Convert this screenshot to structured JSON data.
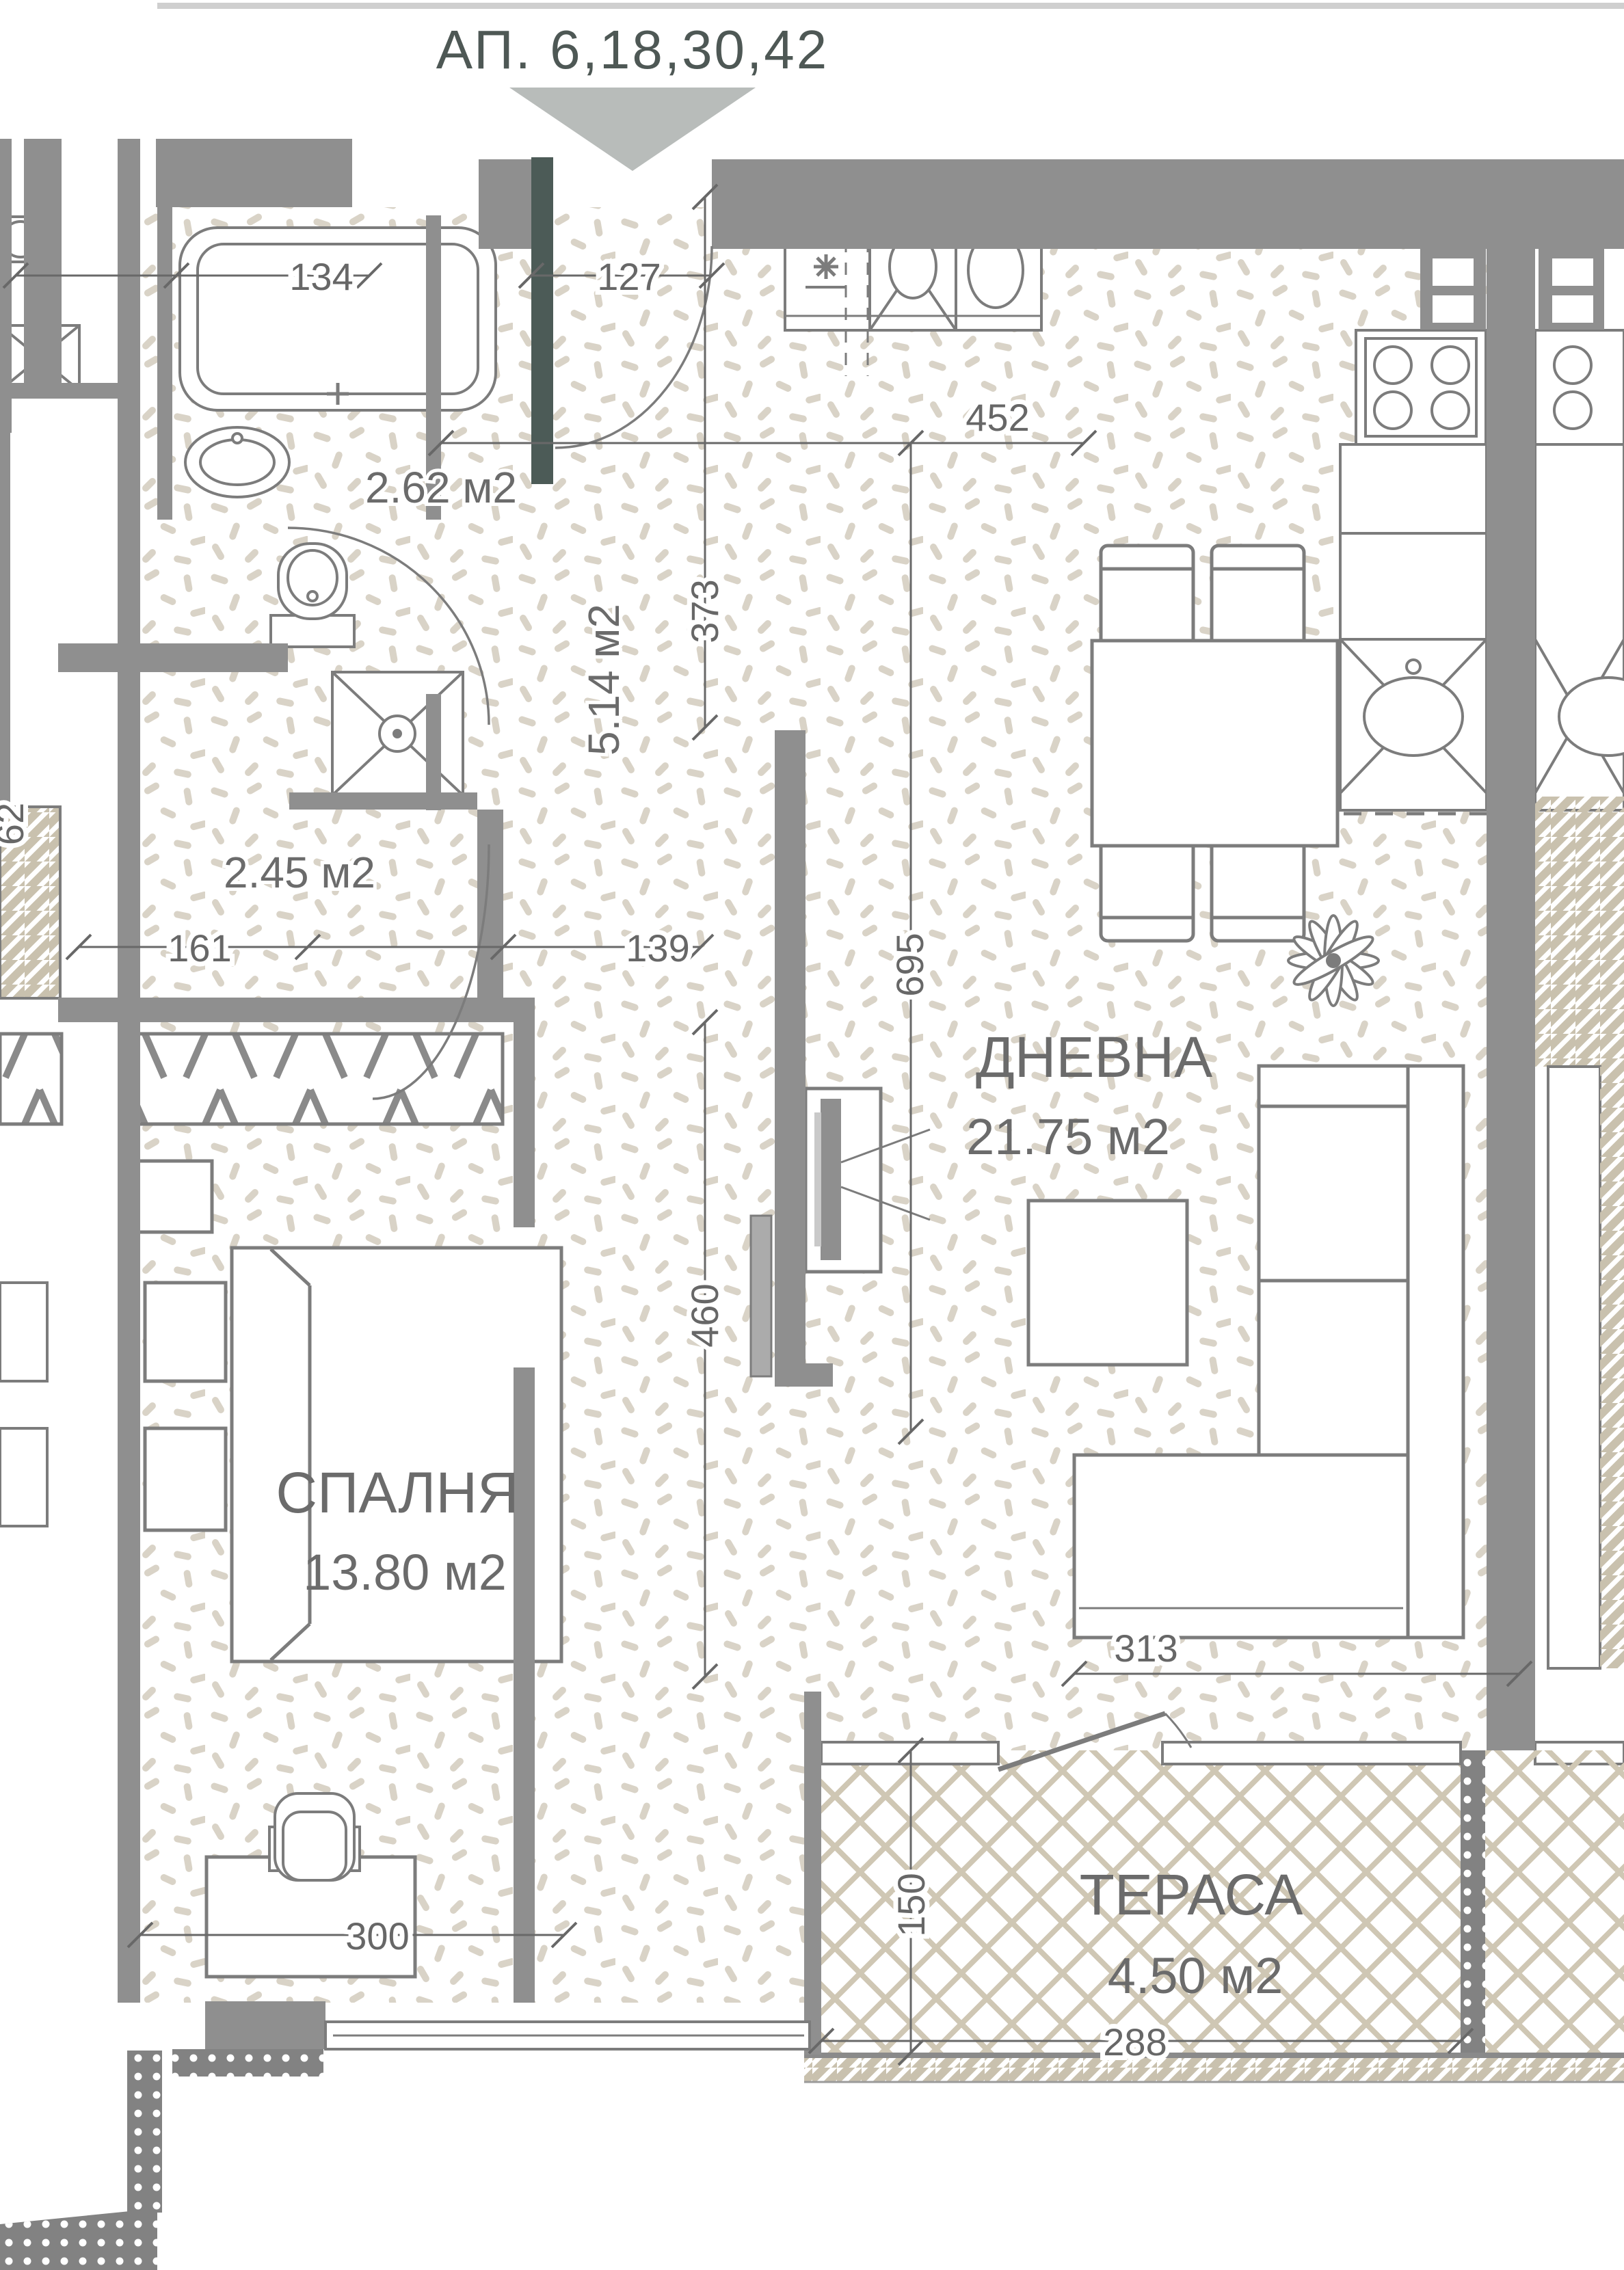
{
  "title": "АП. 6,18,30,42",
  "rooms": {
    "living": {
      "name": "ДНЕВНА",
      "area": "21.75 м2"
    },
    "bedroom": {
      "name": "СПАЛНЯ",
      "area": "13.80 м2"
    },
    "terrace": {
      "name": "ТЕРАСА",
      "area": "4.50 м2"
    },
    "bathroom": {
      "area": "2.62 м2"
    },
    "hall": {
      "area": "5.14 м2"
    },
    "wc": {
      "area": "2.45 м2"
    }
  },
  "dims": {
    "d134": "134",
    "d127": "127",
    "d452": "452",
    "d373": "373",
    "d695": "695",
    "d161": "161",
    "d139": "139",
    "d460": "460",
    "d313": "313",
    "d300": "300",
    "d150": "150",
    "d288": "288",
    "d62": "62"
  },
  "colors": {
    "wall": "#8f8f8f",
    "wall_dark": "#4c5b57",
    "outline": "#7c7c7c",
    "dim_line": "#686868",
    "label_text": "#6b6b6b",
    "title_text": "#4e5855",
    "speckle": "#d9d3c7",
    "lattice": "#cfc7b4",
    "stripe": "#c9c1ae",
    "arrow": "#b8bcba",
    "railing": "#828282"
  }
}
